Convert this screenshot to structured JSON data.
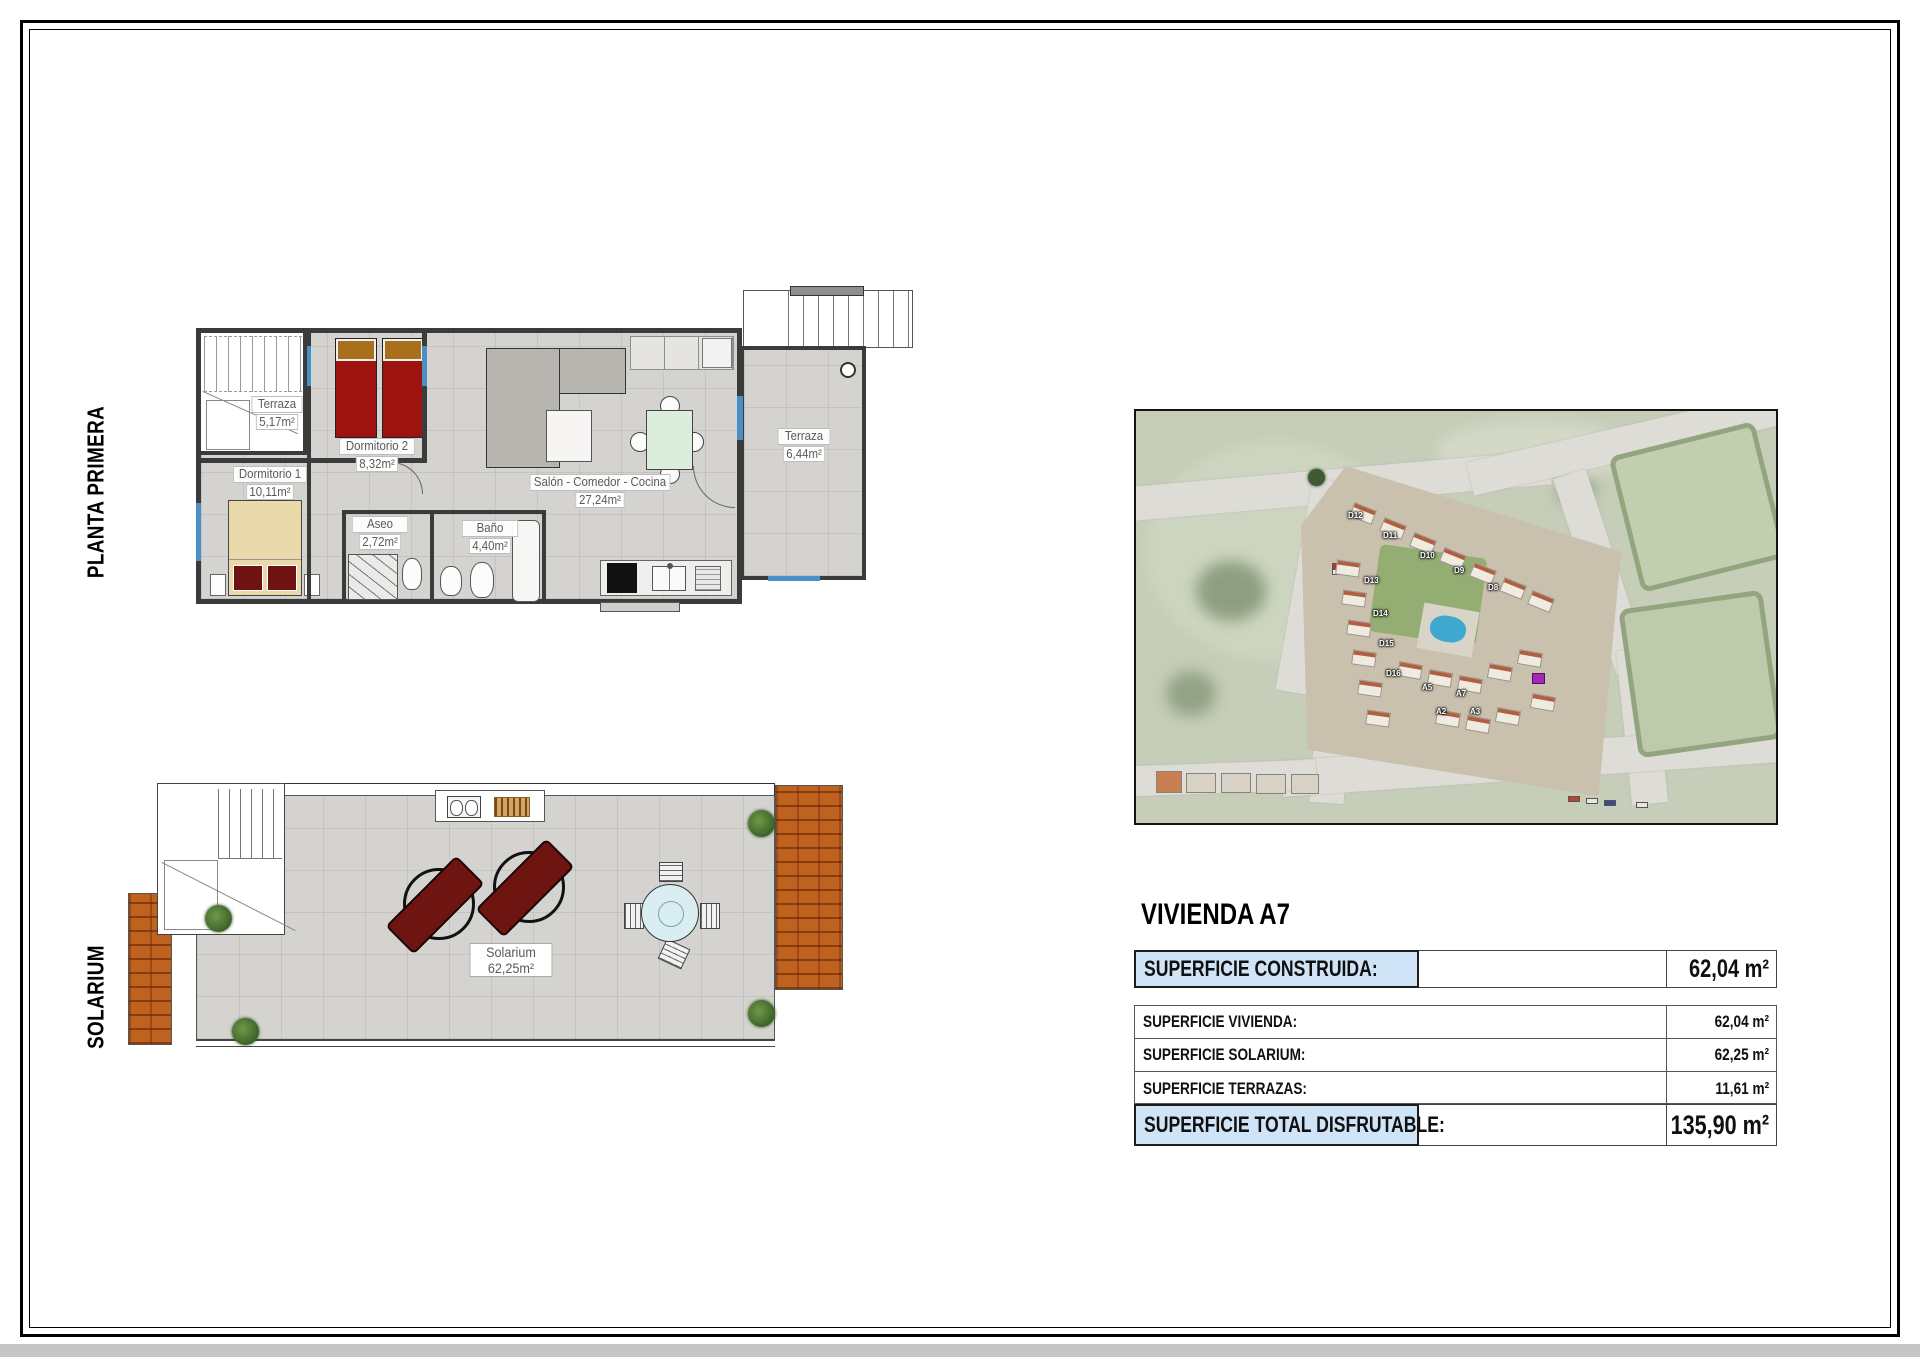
{
  "side_labels": {
    "top": "PLANTA PRIMERA",
    "bottom": "SOLARIUM"
  },
  "floor_plan": {
    "rooms": [
      {
        "name": "Terraza",
        "area": "5,17m²"
      },
      {
        "name": "Dormitorio 2",
        "area": "8,32m²"
      },
      {
        "name": "Salón - Comedor - Cocina",
        "area": "27,24m²"
      },
      {
        "name": "Terraza",
        "area": "6,44m²"
      },
      {
        "name": "Dormitorio 1",
        "area": "10,11m²"
      },
      {
        "name": "Aseo",
        "area": "2,72m²"
      },
      {
        "name": "Baño",
        "area": "4,40m²"
      }
    ]
  },
  "solarium_plan": {
    "name": "Solarium",
    "area": "62,25m²"
  },
  "aerial": {
    "labels": [
      "D12",
      "D11",
      "D10",
      "D9",
      "D8",
      "D13",
      "D14",
      "D15",
      "D16",
      "A5",
      "A7",
      "A2",
      "A3"
    ]
  },
  "info": {
    "title": "VIVIENDA A7",
    "construida": {
      "label": "SUPERFICIE CONSTRUIDA:",
      "value": "62,04 m²"
    },
    "rows": [
      {
        "label": "SUPERFICIE VIVIENDA:",
        "value": "62,04 m²"
      },
      {
        "label": "SUPERFICIE SOLARIUM:",
        "value": "62,25 m²"
      },
      {
        "label": "SUPERFICIE TERRAZAS:",
        "value": "11,61 m²"
      }
    ],
    "total": {
      "label": "SUPERFICIE TOTAL DISFRUTABLE:",
      "value": "135,90 m²"
    }
  }
}
